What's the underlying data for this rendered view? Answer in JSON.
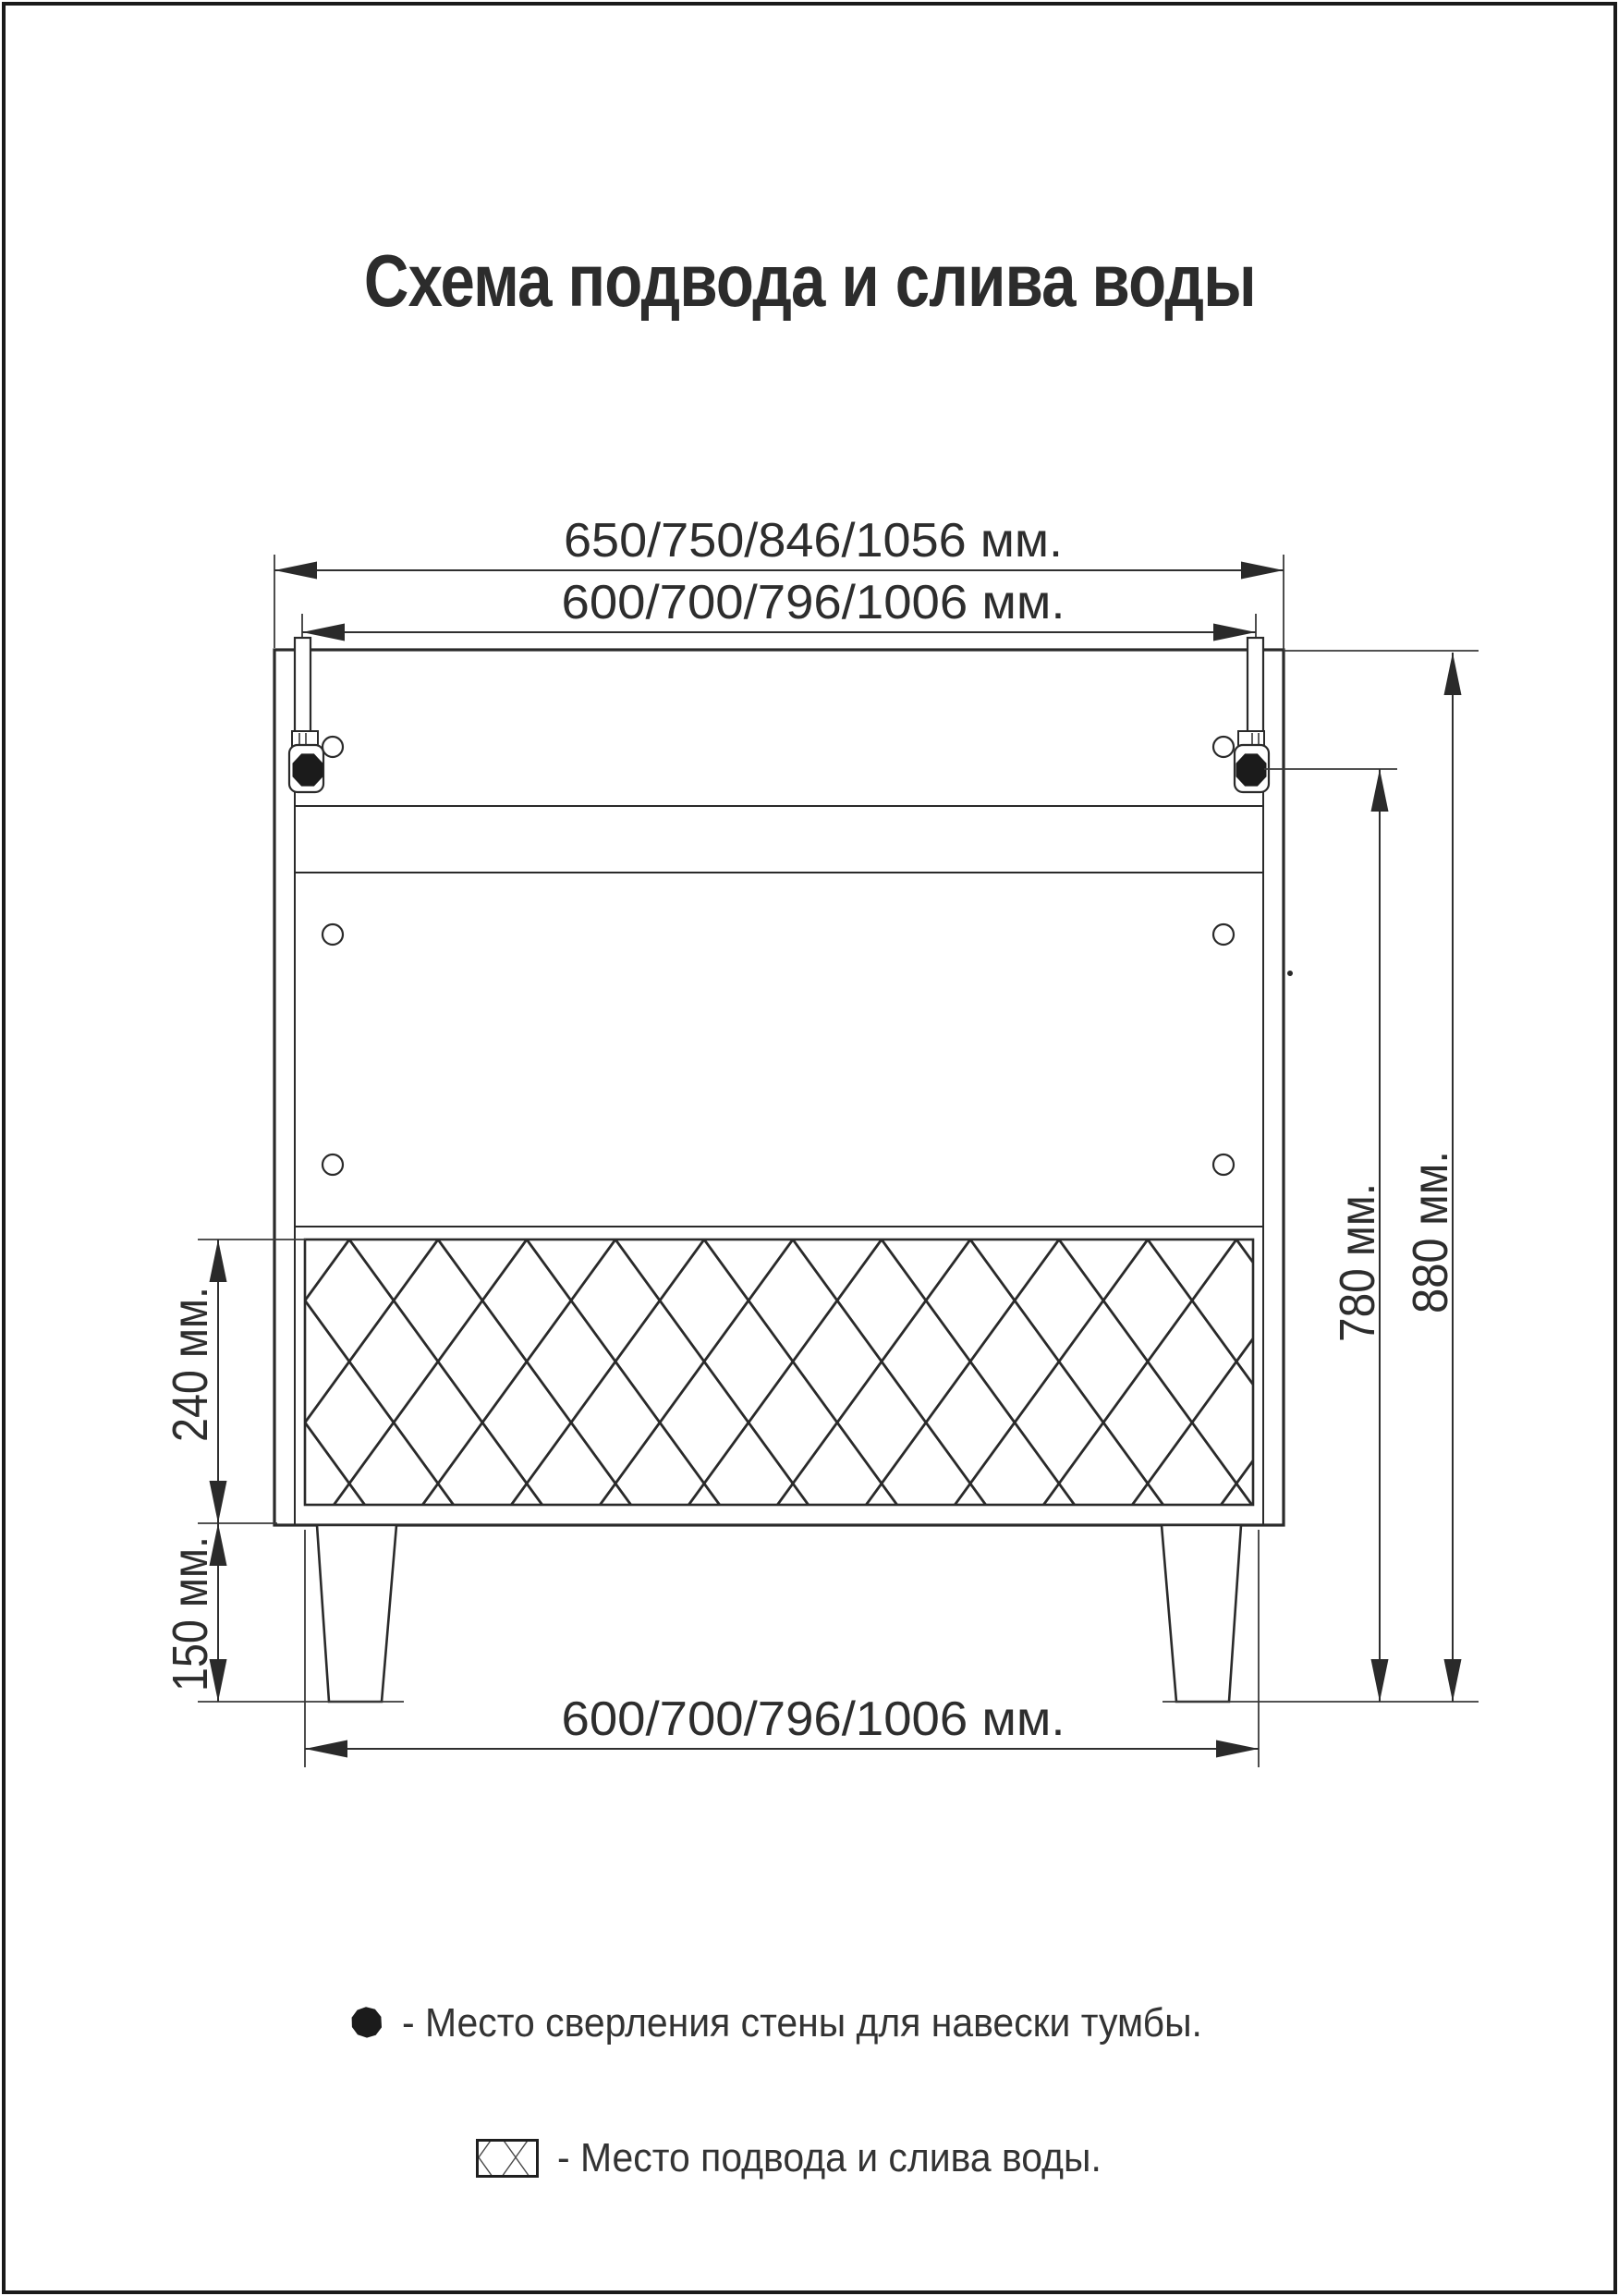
{
  "title": "Схема подвода и слива воды",
  "colors": {
    "ink": "#2a2a2a",
    "text": "#2d2d2d",
    "drill_point_fill": "#1b1b1b",
    "background": "#ffffff"
  },
  "diagram": {
    "dims": {
      "top_outer": "650/750/846/1056 мм.",
      "top_inner": "600/700/796/1006 мм.",
      "bottom": "600/700/796/1006 мм.",
      "drill_height": "780 мм.",
      "total_height": "880 мм.",
      "water_zone_height": "240 мм.",
      "leg_height": "150 мм."
    }
  },
  "legend": {
    "drill_point": {
      "icon": "black-octagon-dot",
      "label": "- Место сверления стены для навески тумбы."
    },
    "water_zone": {
      "icon": "cross-hatched-rectangle",
      "label": "- Место подвода и слива воды."
    }
  }
}
